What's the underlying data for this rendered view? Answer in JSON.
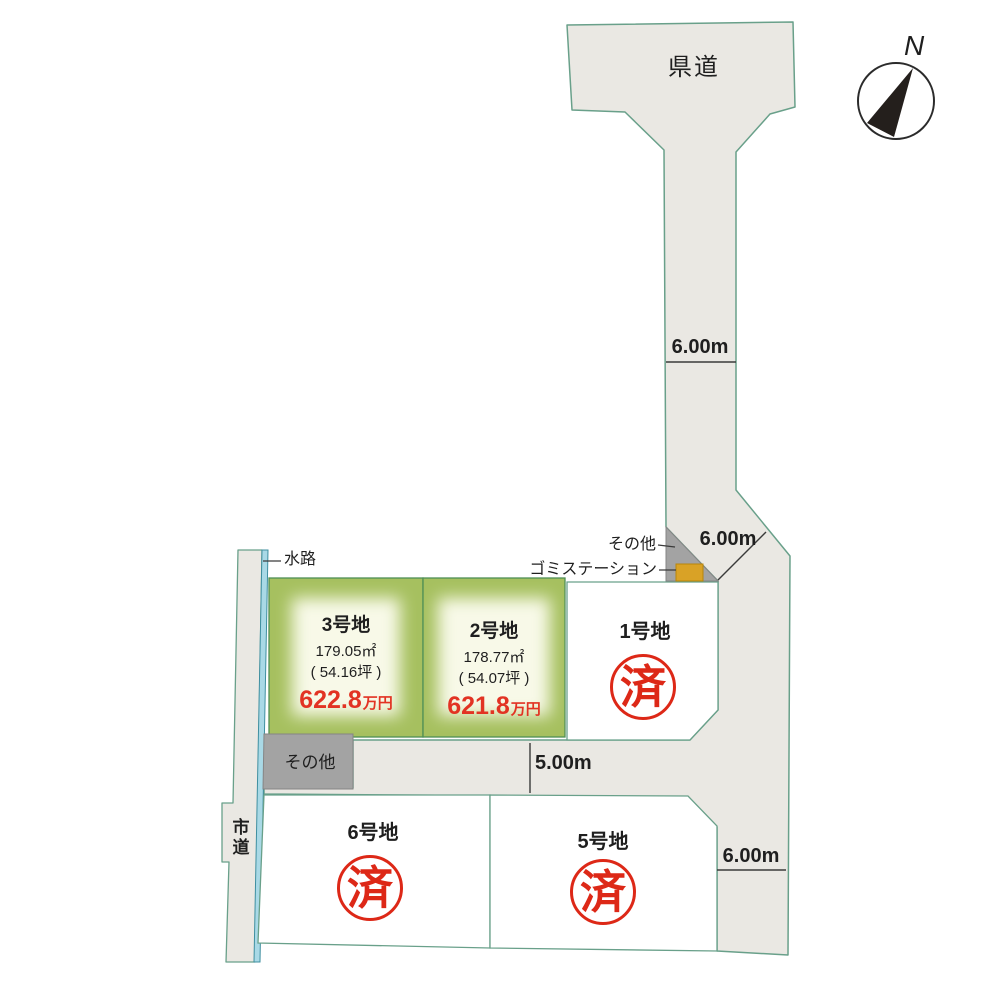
{
  "labels": {
    "prefectural_road": "県道",
    "city_road": "市道",
    "waterway": "水路",
    "other_right": "その他",
    "other_left": "その他",
    "garbage_station": "ゴミステーション",
    "compass_north": "N"
  },
  "dimensions": {
    "upper_road_width": "6.00m",
    "bend_road_width": "6.00m",
    "south_road_width": "5.00m",
    "east_road_width": "6.00m"
  },
  "plots": [
    {
      "name": "1号地",
      "status": "sold",
      "stamp": "済"
    },
    {
      "name": "2号地",
      "area_sqm": "178.77㎡",
      "area_tsubo": "( 54.07坪 )",
      "price_value": "621.8",
      "price_unit": "万円"
    },
    {
      "name": "3号地",
      "area_sqm": "179.05㎡",
      "area_tsubo": "( 54.16坪 )",
      "price_value": "622.8",
      "price_unit": "万円"
    },
    {
      "name": "5号地",
      "status": "sold",
      "stamp": "済"
    },
    {
      "name": "6号地",
      "status": "sold",
      "stamp": "済"
    }
  ],
  "colors": {
    "road_fill": "#eae8e3",
    "parcel_outline": "#69a08a",
    "green_plot": "#a6c05f",
    "green_plot_glow": "#f8f9e8",
    "green_plot_border": "#4f8f55",
    "waterway_fill": "#a9d9e6",
    "other_gray": "#a3a3a3",
    "garbage_yellow": "#d9a226",
    "price_red": "#e23323",
    "stamp_red": "#dd2817",
    "line_dark": "#3a3a3a"
  }
}
